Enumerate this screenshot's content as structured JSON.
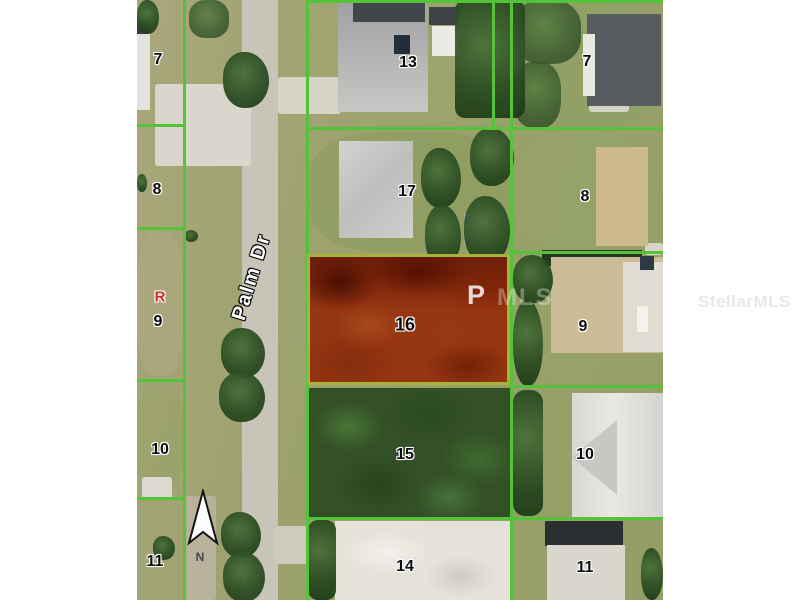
{
  "map_overlay": {
    "street_label": "Palm Dr",
    "north_label": "N",
    "marker_r": "R",
    "highlighted_parcel": "16",
    "parcel_labels_left": [
      "7",
      "8",
      "9",
      "10",
      "11"
    ],
    "parcel_labels_middle": [
      "13",
      "17",
      "15",
      "14"
    ],
    "parcel_labels_right": [
      "7",
      "8",
      "9",
      "10",
      "11"
    ]
  },
  "watermarks": {
    "partial_p": "P",
    "partial_mls": "MLS",
    "stellar_mls": "StellarMLS"
  },
  "colors": {
    "parcel_line_green": "#55c33a",
    "highlight_red_fill": "#963511",
    "highlight_border": "#a8b23a",
    "road_gray": "#c8c4b8",
    "watermark_gray": "#e7e7e7"
  }
}
